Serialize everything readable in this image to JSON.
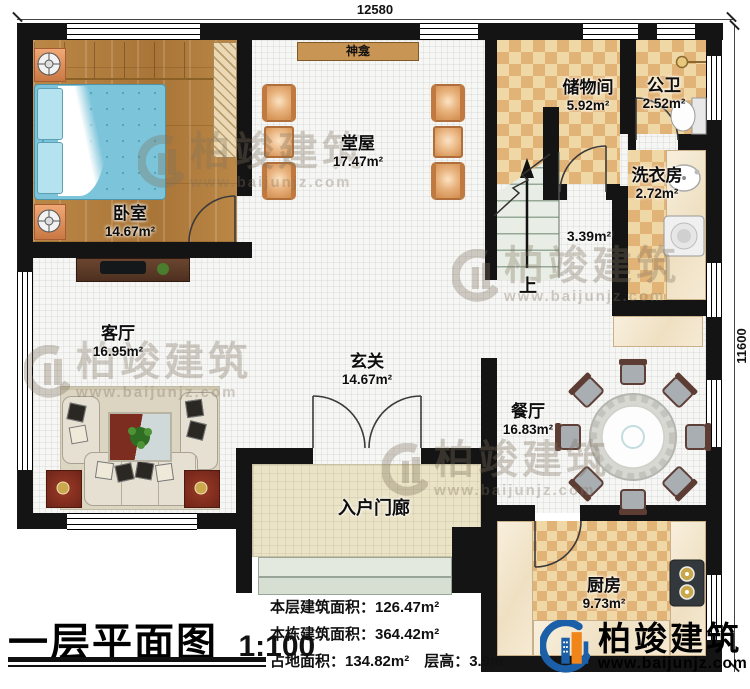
{
  "plan": {
    "dim_top": "12580",
    "dim_right": "11600"
  },
  "rooms": {
    "bedroom": {
      "name": "卧室",
      "area": "14.67m²"
    },
    "hall": {
      "name": "堂屋",
      "area": "17.47m²"
    },
    "shrine": {
      "name": "神龛"
    },
    "storage": {
      "name": "储物间",
      "area": "5.92m²"
    },
    "bathroom": {
      "name": "公卫",
      "area": "2.52m²"
    },
    "laundry": {
      "name": "洗衣房",
      "area": "2.72m²"
    },
    "stairs": {
      "area": "3.39m²",
      "up_label": "上"
    },
    "living": {
      "name": "客厅",
      "area": "16.95m²"
    },
    "foyer": {
      "name": "玄关",
      "area": "14.67m²"
    },
    "dining": {
      "name": "餐厅",
      "area": "16.83m²"
    },
    "kitchen": {
      "name": "厨房",
      "area": "9.73m²"
    },
    "porch": {
      "name": "入户门廊"
    }
  },
  "title_block": {
    "title": "一层平面图",
    "scale": "1:100",
    "stats": [
      "本层建筑面积：126.47m²",
      "本栋建筑面积：364.42m²",
      "占地面积：134.82m²　层高：3.9m"
    ]
  },
  "brand": {
    "name": "柏竣建筑",
    "url": "www.baijunjz.com"
  },
  "watermark": {
    "name": "柏竣建筑",
    "url": "www.baijunjz.com"
  },
  "colors": {
    "wall": "#141414",
    "checker_dark": "#e2b377",
    "checker_light": "#f0d7a6",
    "accent_blue": "#1a5fa8",
    "accent_orange": "#f08519"
  }
}
